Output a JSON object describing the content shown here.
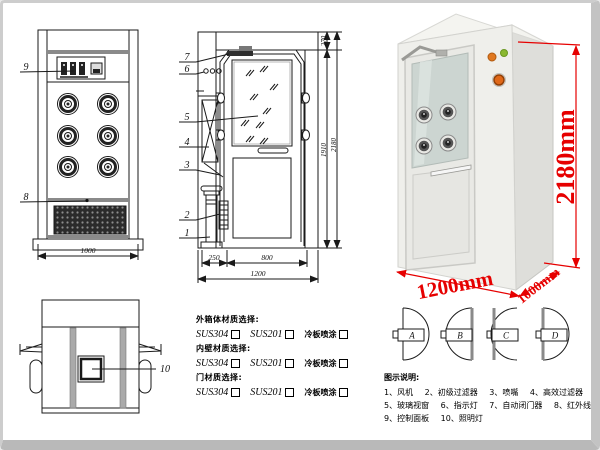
{
  "front_view": {
    "callout_control_panel": "9",
    "callout_grille": "8",
    "width_dim": "1000"
  },
  "side_view": {
    "callouts": [
      "7",
      "6",
      "5",
      "4",
      "3",
      "2",
      "1"
    ],
    "dims": {
      "left_section": "250",
      "door_width": "800",
      "total_width": "1200",
      "door_height": "1910",
      "total_height": "2180",
      "top_section": "270"
    }
  },
  "top_view": {
    "callout_lamp": "10"
  },
  "photo": {
    "height_label": "2180mm",
    "width_label": "1200mm",
    "depth_label": "1000mm"
  },
  "materials": {
    "groups": [
      {
        "heading": "外箱体材质选择:",
        "opt1": "SUS304",
        "opt2": "SUS201",
        "opt3": "冷板喷涂"
      },
      {
        "heading": "内壁材质选择:",
        "opt1": "SUS304",
        "opt2": "SUS201",
        "opt3": "冷板喷涂"
      },
      {
        "heading": "门材质选择:",
        "opt1": "SUS304",
        "opt2": "SUS201",
        "opt3": "冷板喷涂"
      }
    ]
  },
  "door_configs": {
    "a": "A",
    "b": "B",
    "c": "C",
    "d": "D"
  },
  "legend": {
    "title": "图示说明:",
    "row1": [
      "1、风机",
      "2、初级过滤器",
      "3、喷嘴",
      "4、高效过滤器"
    ],
    "row2": [
      "5、玻璃视窗",
      "6、指示灯",
      "7、自动闭门器",
      "8、红外线感应器"
    ],
    "row3": [
      "9、控制面板",
      "10、照明灯"
    ]
  },
  "colors": {
    "dimension_red": "#e60000",
    "line_color": "#1a1a1a"
  }
}
